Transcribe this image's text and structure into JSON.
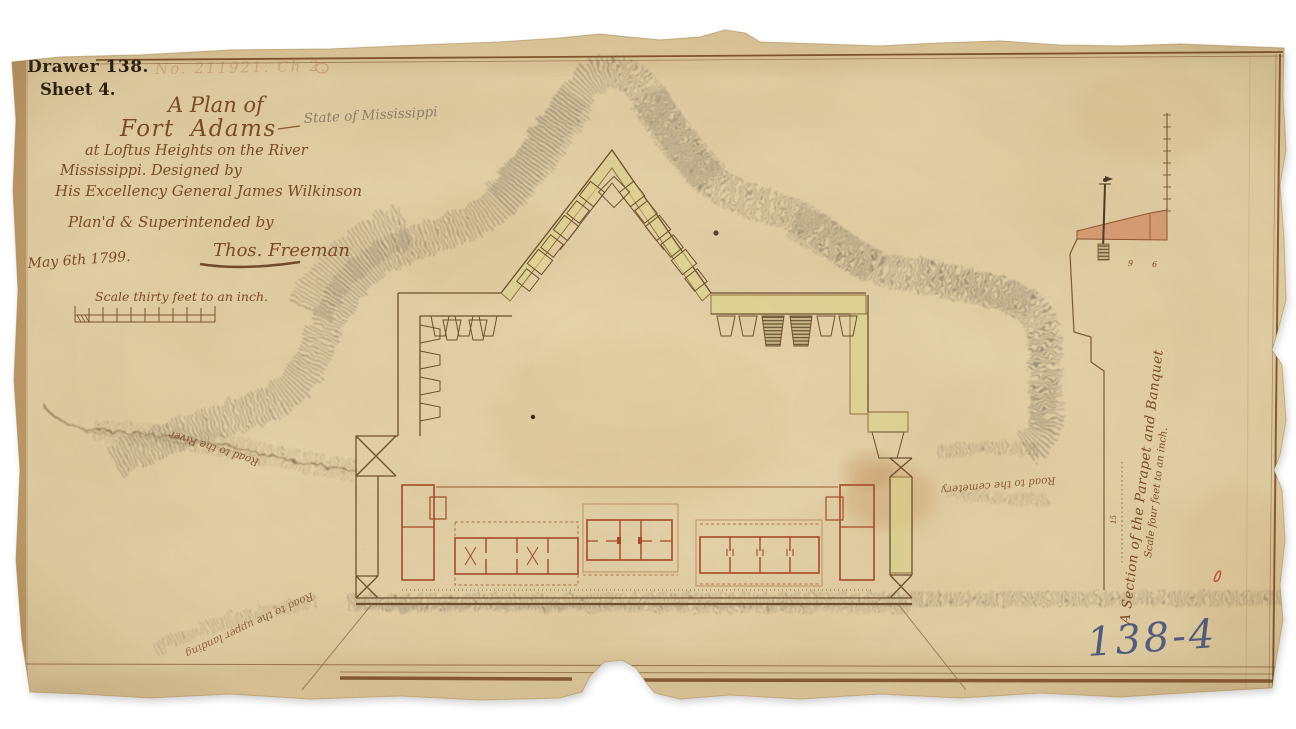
{
  "colors": {
    "paper": "#e8d6ad",
    "ink_brown": "#7b4a28",
    "building_red": "#a8492a",
    "wash_yellow": "#ddd28f",
    "wash_pink": "#d79a72",
    "graphite": "#6f6757",
    "stamp_black": "#241a10",
    "catalog_blue": "#35497c",
    "pencil_gray": "#8d8069"
  },
  "header": {
    "drawer_label": "Drawer 138.",
    "sheet_label": "Sheet 4.",
    "faded_inscription": "No. 211921. Ch 2."
  },
  "title_block": {
    "line1": "A Plan of",
    "line2": "Fort Adams",
    "pencil_annotation": "State of Mississippi",
    "line3": "at Loftus Heights on the River",
    "line4": "Mississippi. Designed by",
    "line5": "His Excellency General James Wilkinson",
    "line6": "Plan'd & Superintended by",
    "signature": "Thos. Freeman",
    "date": "May 6th 1799.",
    "scale_note": "Scale thirty feet to an inch."
  },
  "plan_annotations": {
    "road_to_river": "Road to the River",
    "road_to_upper_landing": "Road to the upper landing",
    "road_to_cemetery": "Road to the cemetery"
  },
  "section_figure": {
    "caption_line1": "A Section of the Parapet and Banquet",
    "caption_line2": "Scale four feet to an inch.",
    "dimension_a": "9",
    "dimension_b": "6",
    "dimension_c": "15"
  },
  "archival": {
    "catalog_number": "138-4"
  }
}
